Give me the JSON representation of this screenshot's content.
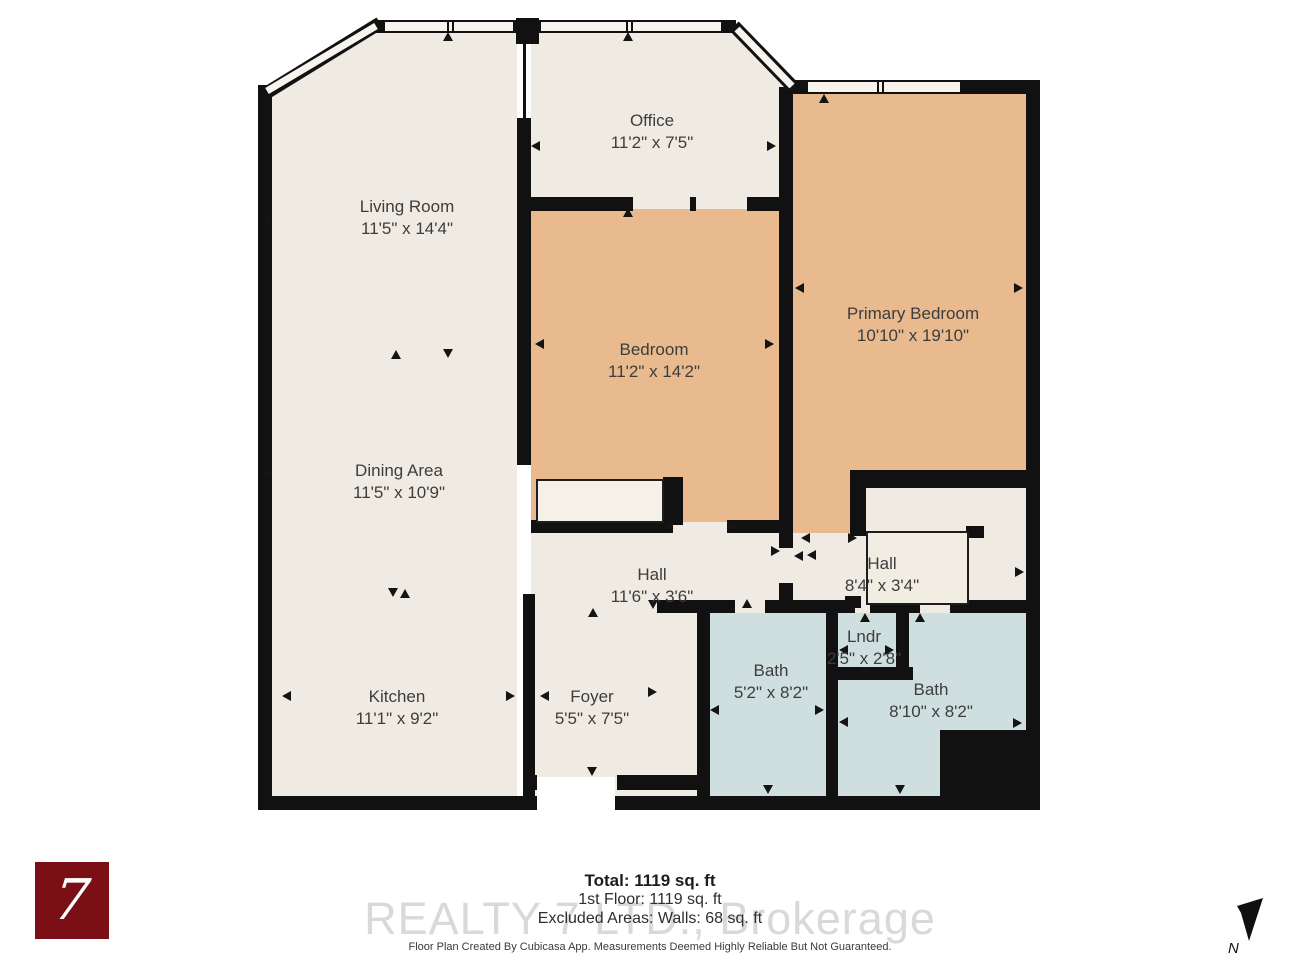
{
  "plan": {
    "rooms": [
      {
        "name": "Living Room",
        "dims": "11'5\" x 14'4\""
      },
      {
        "name": "Office",
        "dims": "11'2\" x 7'5\""
      },
      {
        "name": "Primary Bedroom",
        "dims": "10'10\" x 19'10\""
      },
      {
        "name": "Bedroom",
        "dims": "11'2\" x 14'2\""
      },
      {
        "name": "Dining Area",
        "dims": "11'5\" x 10'9\""
      },
      {
        "name": "Hall",
        "dims": "11'6\" x 3'6\""
      },
      {
        "name": "Hall",
        "dims": "8'4\" x 3'4\""
      },
      {
        "name": "Kitchen",
        "dims": "11'1\" x 9'2\""
      },
      {
        "name": "Foyer",
        "dims": "5'5\" x 7'5\""
      },
      {
        "name": "Bath",
        "dims": "5'2\" x 8'2\""
      },
      {
        "name": "Lndr",
        "dims": "2'5\" x 2'8\""
      },
      {
        "name": "Bath",
        "dims": "8'10\" x 8'2\""
      }
    ]
  },
  "summary": {
    "total": "Total: 1119 sq. ft",
    "first_floor": "1st Floor: 1119 sq. ft",
    "excluded": "Excluded Areas: Walls: 68 sq. ft"
  },
  "watermark": "REALTY 7 LTD., Brokerage",
  "footer": "Floor Plan Created By Cubicasa App. Measurements Deemed Highly Reliable But Not Guaranteed.",
  "logo": {
    "glyph": "7"
  },
  "compass": {
    "label": "N"
  },
  "colors": {
    "floor_cream": "#f0ebe2",
    "floor_tan": "#e8ba8d",
    "floor_blue": "#cfdfdf",
    "wall": "#111111",
    "logo_red": "#7a1016",
    "label_text": "#3d3d3d",
    "watermark_gray": "#d9d9d9"
  }
}
